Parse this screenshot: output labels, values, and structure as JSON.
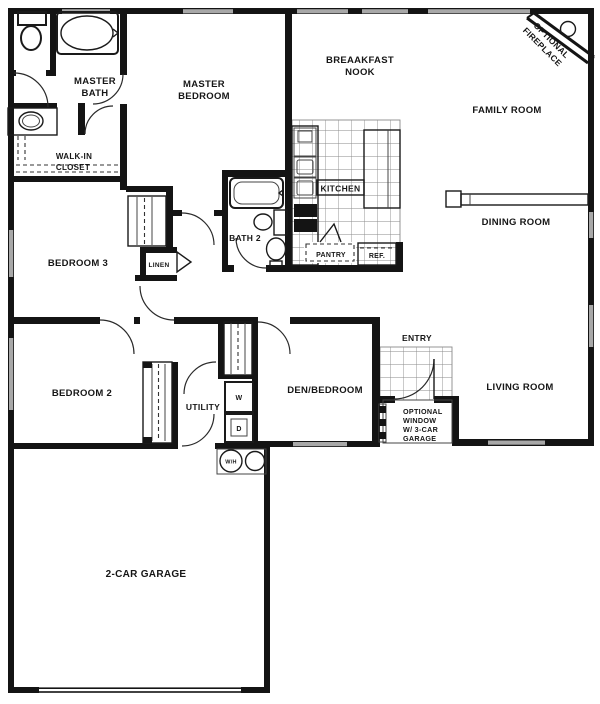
{
  "document": {
    "type": "scanned floor plan",
    "title": "Single-story house floor plan with 2-car garage"
  },
  "rooms": {
    "master_bath": [
      "MASTER",
      "BATH"
    ],
    "walk_in_closet": [
      "WALK-IN",
      "CLOSET"
    ],
    "master_bedroom": [
      "MASTER",
      "BEDROOM"
    ],
    "breakfast_nook": [
      "BREAAKFAST",
      "NOOK"
    ],
    "optional_fireplace": [
      "OPTIONAL",
      "FIREPLACE"
    ],
    "family_room": "FAMILY ROOM",
    "dining_room": "DINING ROOM",
    "kitchen": "KITCHEN",
    "pantry": "PANTRY",
    "refrigerator": "REF.",
    "bath_2": "BATH 2",
    "linen": "LINEN",
    "bedroom_3": "BEDROOM 3",
    "bedroom_2": "BEDROOM 2",
    "utility": "UTILITY",
    "den_bedroom": "DEN/BEDROOM",
    "entry": "ENTRY",
    "living_room": "LIVING ROOM",
    "optional_window_note": [
      "OPTIONAL",
      "WINDOW",
      "W/ 3-CAR",
      "GARAGE"
    ],
    "garage": "2-CAR GARAGE"
  },
  "appliances": {
    "washer": "W",
    "dryer": "D",
    "water_heater": "W/H"
  },
  "colors": {
    "wall": "#141414",
    "window_fill": "#a8a8a8",
    "paper": "#ffffff",
    "text": "#161616"
  }
}
